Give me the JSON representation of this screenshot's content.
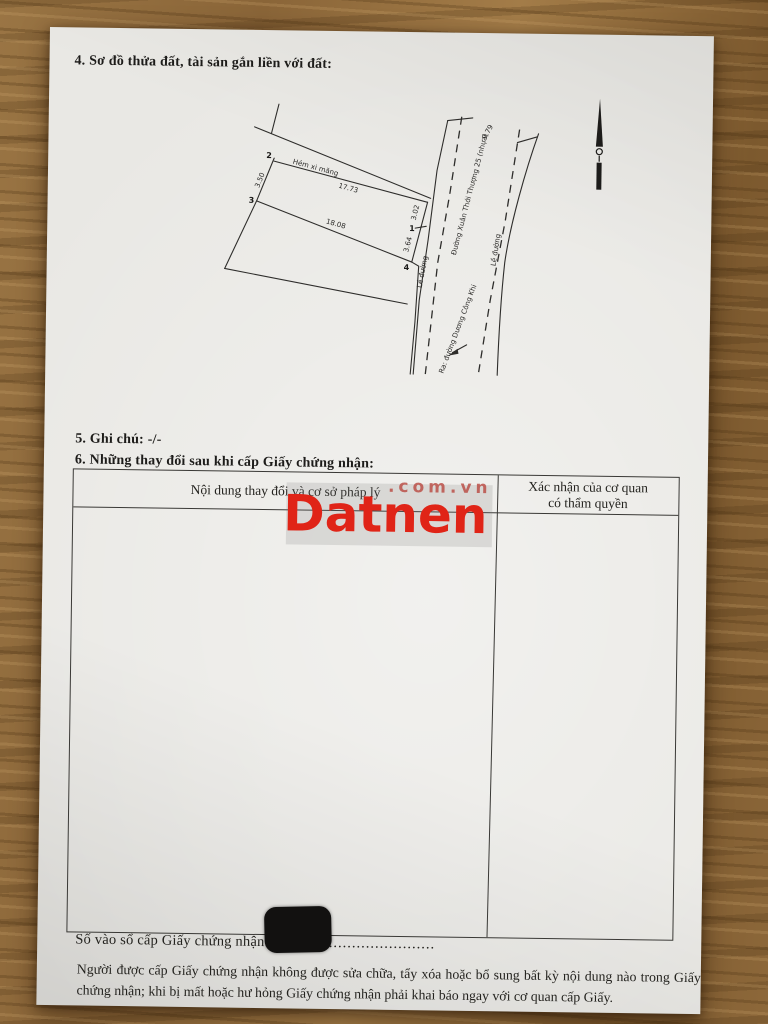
{
  "sections": {
    "plot_diagram_heading": "4. Sơ đồ thửa đất, tài sản gắn liền với đất:",
    "notes_label": "5. Ghi chú:",
    "notes_value": "-/-",
    "changes_heading": "6. Những thay đổi sau khi cấp Giấy chứng nhận:"
  },
  "diagram": {
    "points": {
      "p1": "1",
      "p2": "2",
      "p3": "3",
      "p4": "4"
    },
    "measurements": {
      "top_edge": "17.73",
      "bottom_edge": "18.08",
      "left_edge": "3.50",
      "right_edge_upper": "3.02",
      "right_edge_lower": "3.64",
      "road_width": "9.79"
    },
    "labels": {
      "alley": "Hẻm xi măng",
      "road_edge_left": "Lề đường",
      "road_edge_right": "Lề đường",
      "street": "Đường Xuân Thới Thượng 25 (nhựa)",
      "exit_note": "Ra: đường Dương Công Khi"
    }
  },
  "table": {
    "header_left": "Nội dung thay đổi và cơ sở pháp lý",
    "header_right_line1": "Xác nhận của cơ quan",
    "header_right_line2": "có thẩm quyền"
  },
  "footer": {
    "registry_label": "Số vào sổ cấp Giấy chứng nhận:",
    "registry_dots": "....................................",
    "note": "Người được cấp Giấy chứng nhận không được sửa chữa, tẩy xóa hoặc bổ sung bất kỳ nội dung nào trong Giấy chứng nhận; khi bị mất hoặc hư hỏng Giấy chứng nhận phải khai báo ngay với cơ quan cấp Giấy."
  },
  "watermark": {
    "brand": "Datnen",
    "suffix": ".com.vn",
    "brand_color": "#e02417"
  }
}
